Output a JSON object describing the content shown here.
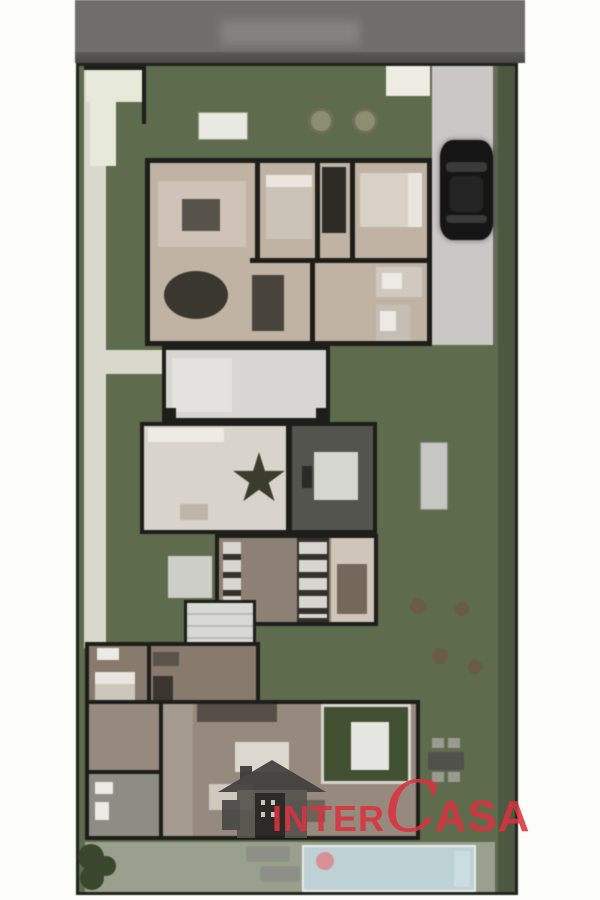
{
  "watermark": {
    "inter": "INTER",
    "c": "C",
    "asa": "ASA"
  },
  "areas": [
    {
      "name": "street"
    },
    {
      "name": "front-garden"
    },
    {
      "name": "driveway"
    },
    {
      "name": "upper-floor-plan"
    },
    {
      "name": "terrace"
    },
    {
      "name": "ground-floor-plan"
    },
    {
      "name": "service-rooms"
    },
    {
      "name": "staircase"
    },
    {
      "name": "bedroom-suite"
    },
    {
      "name": "lower-floor-plan"
    },
    {
      "name": "back-lawn"
    },
    {
      "name": "pool-deck"
    },
    {
      "name": "pool"
    }
  ],
  "colors": {
    "road": "#6f6e6b",
    "lawn": "#5e6b4b",
    "lawnDark": "#4c5840",
    "path": "#d8d9cb",
    "entry": "#e7e9d9",
    "drive": "#c9c8c4",
    "wall": "#1d1d1a",
    "car": "#151515",
    "floorUpper": "#c2b3a3",
    "floorMid": "#d8d4cc",
    "floorService": "#8e8073",
    "floorBedroom": "#897a6b",
    "floorBottom": "#97897c",
    "terrace": "#d7d6d2",
    "stairs": "#d8d8d5",
    "mediaRoom": "#54544e",
    "courtyard": "#41502f",
    "pool": "#bdd1d5",
    "deck": "#99a18d",
    "brand": "#dc323e"
  }
}
